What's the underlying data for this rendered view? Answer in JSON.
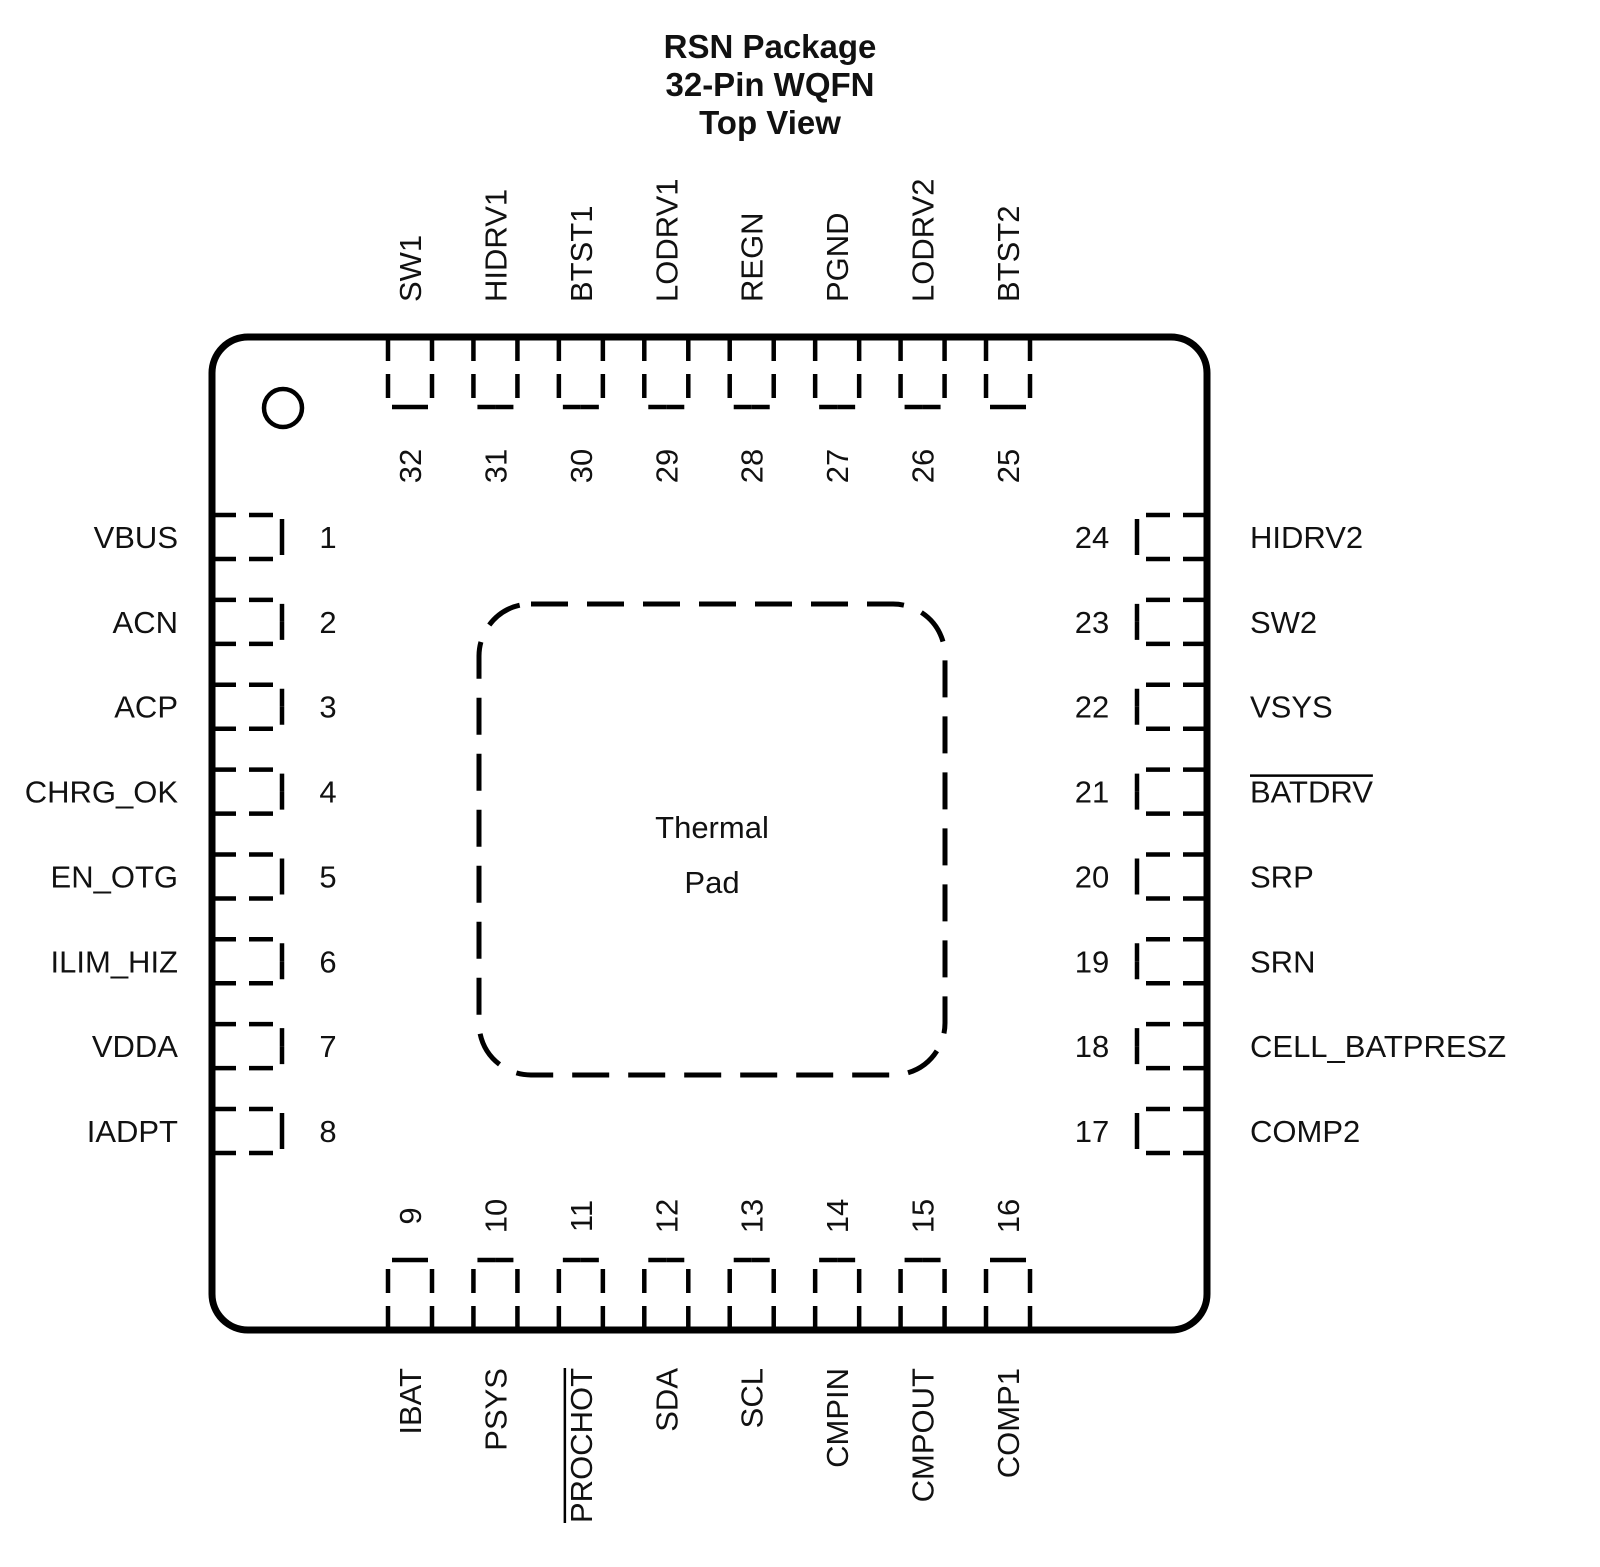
{
  "title": {
    "lines": [
      "RSN Package",
      "32-Pin WQFN",
      "Top View"
    ]
  },
  "thermal_pad": {
    "lines": [
      "Thermal",
      "Pad"
    ]
  },
  "pins": {
    "top": [
      {
        "number": "32",
        "label": "SW1"
      },
      {
        "number": "31",
        "label": "HIDRV1"
      },
      {
        "number": "30",
        "label": "BTST1"
      },
      {
        "number": "29",
        "label": "LODRV1"
      },
      {
        "number": "28",
        "label": "REGN"
      },
      {
        "number": "27",
        "label": "PGND"
      },
      {
        "number": "26",
        "label": "LODRV2"
      },
      {
        "number": "25",
        "label": "BTST2"
      }
    ],
    "left": [
      {
        "number": "1",
        "label": "VBUS"
      },
      {
        "number": "2",
        "label": "ACN"
      },
      {
        "number": "3",
        "label": "ACP"
      },
      {
        "number": "4",
        "label": "CHRG_OK"
      },
      {
        "number": "5",
        "label": "EN_OTG"
      },
      {
        "number": "6",
        "label": "ILIM_HIZ"
      },
      {
        "number": "7",
        "label": "VDDA"
      },
      {
        "number": "8",
        "label": "IADPT"
      }
    ],
    "right": [
      {
        "number": "24",
        "label": "HIDRV2"
      },
      {
        "number": "23",
        "label": "SW2"
      },
      {
        "number": "22",
        "label": "VSYS"
      },
      {
        "number": "21",
        "label": "BATDRV",
        "overline": true
      },
      {
        "number": "20",
        "label": "SRP"
      },
      {
        "number": "19",
        "label": "SRN"
      },
      {
        "number": "18",
        "label": "CELL_BATPRESZ"
      },
      {
        "number": "17",
        "label": "COMP2"
      }
    ],
    "bottom": [
      {
        "number": "9",
        "label": "IBAT"
      },
      {
        "number": "10",
        "label": "PSYS"
      },
      {
        "number": "11",
        "label": "PROCHOT",
        "overline": true
      },
      {
        "number": "12",
        "label": "SDA"
      },
      {
        "number": "13",
        "label": "SCL"
      },
      {
        "number": "14",
        "label": "CMPIN"
      },
      {
        "number": "15",
        "label": "CMPOUT"
      },
      {
        "number": "16",
        "label": "COMP1"
      }
    ]
  },
  "colors": {
    "line": "#000000",
    "text": "#111111",
    "background": "#ffffff"
  }
}
